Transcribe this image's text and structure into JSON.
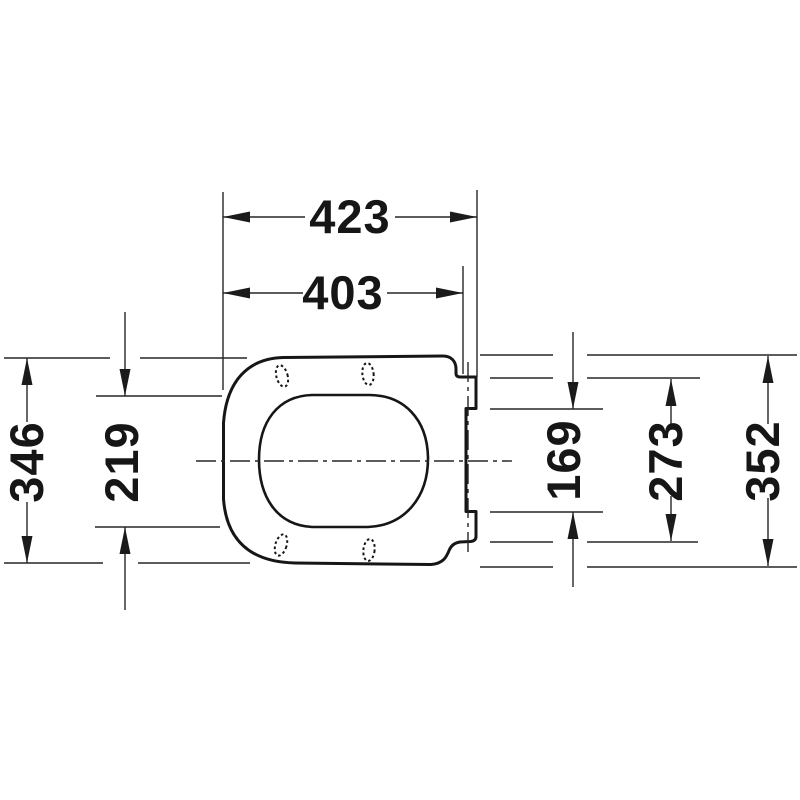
{
  "drawing": {
    "kind": "technical-dimension-drawing",
    "subject": "toilet-seat-top-view",
    "line_color": "#161616",
    "background_color": "#ffffff",
    "dims": {
      "overall_length": {
        "value": "423"
      },
      "length_to_hinge": {
        "value": "403"
      },
      "seat_width": {
        "value": "346"
      },
      "opening_width": {
        "value": "219"
      },
      "hinge_inner_span": {
        "value": "169"
      },
      "hinge_outer_span": {
        "value": "273"
      },
      "hinge_overall_span": {
        "value": "352"
      }
    }
  }
}
